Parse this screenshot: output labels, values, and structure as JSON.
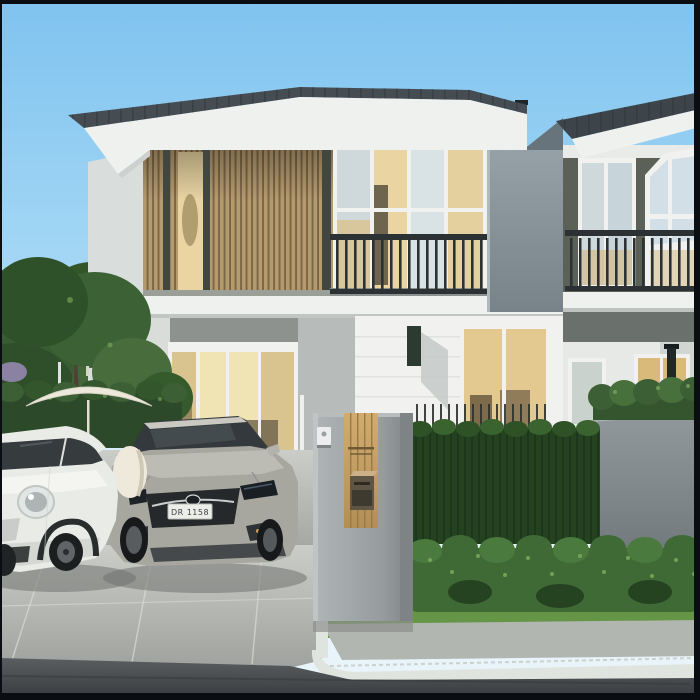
{
  "scene": {
    "type": "architectural exterior rendering",
    "subject": "Modern two-storey townhouses with wooden louver facade, balconies, gate pillar with mailbox, garden hedges and two parked cars"
  },
  "vehicles": {
    "sedan_plate": "DR 1158"
  },
  "palette": {
    "sky-top": "#7fc3ef",
    "sky-mid": "#a6d8f5",
    "sky-low": "#d6ecfa",
    "roof": "#454d53",
    "roof-right": "#3d454b",
    "fascia": "#eff1ef",
    "wall-white": "#f1f2f0",
    "wall-shadow": "#b7bcba",
    "wood": "#b59a6e",
    "wood-dark": "#7b6647",
    "glass-cool": "#cfd9dc",
    "glass-warm": "#e9d4a2",
    "rail": "#2c3133",
    "party-wall": "#8b969c",
    "gray-wall": "#7e878b",
    "hedge-dark": "#24421f",
    "hedge-mid": "#3c5f35",
    "shrub": "#3f6a35",
    "leaf-light": "#7fae5e",
    "grass": "#659647",
    "pavement": "#c0c3bf",
    "curb": "#e0e4de",
    "road": "#4a4e51",
    "pillar": "#979da0",
    "panel-wood": "#c4a064",
    "sedan": "#a7a7a0",
    "mini": "#e9ebe6",
    "umbrella": "#ece8dc",
    "frame": "#0a0e12"
  }
}
